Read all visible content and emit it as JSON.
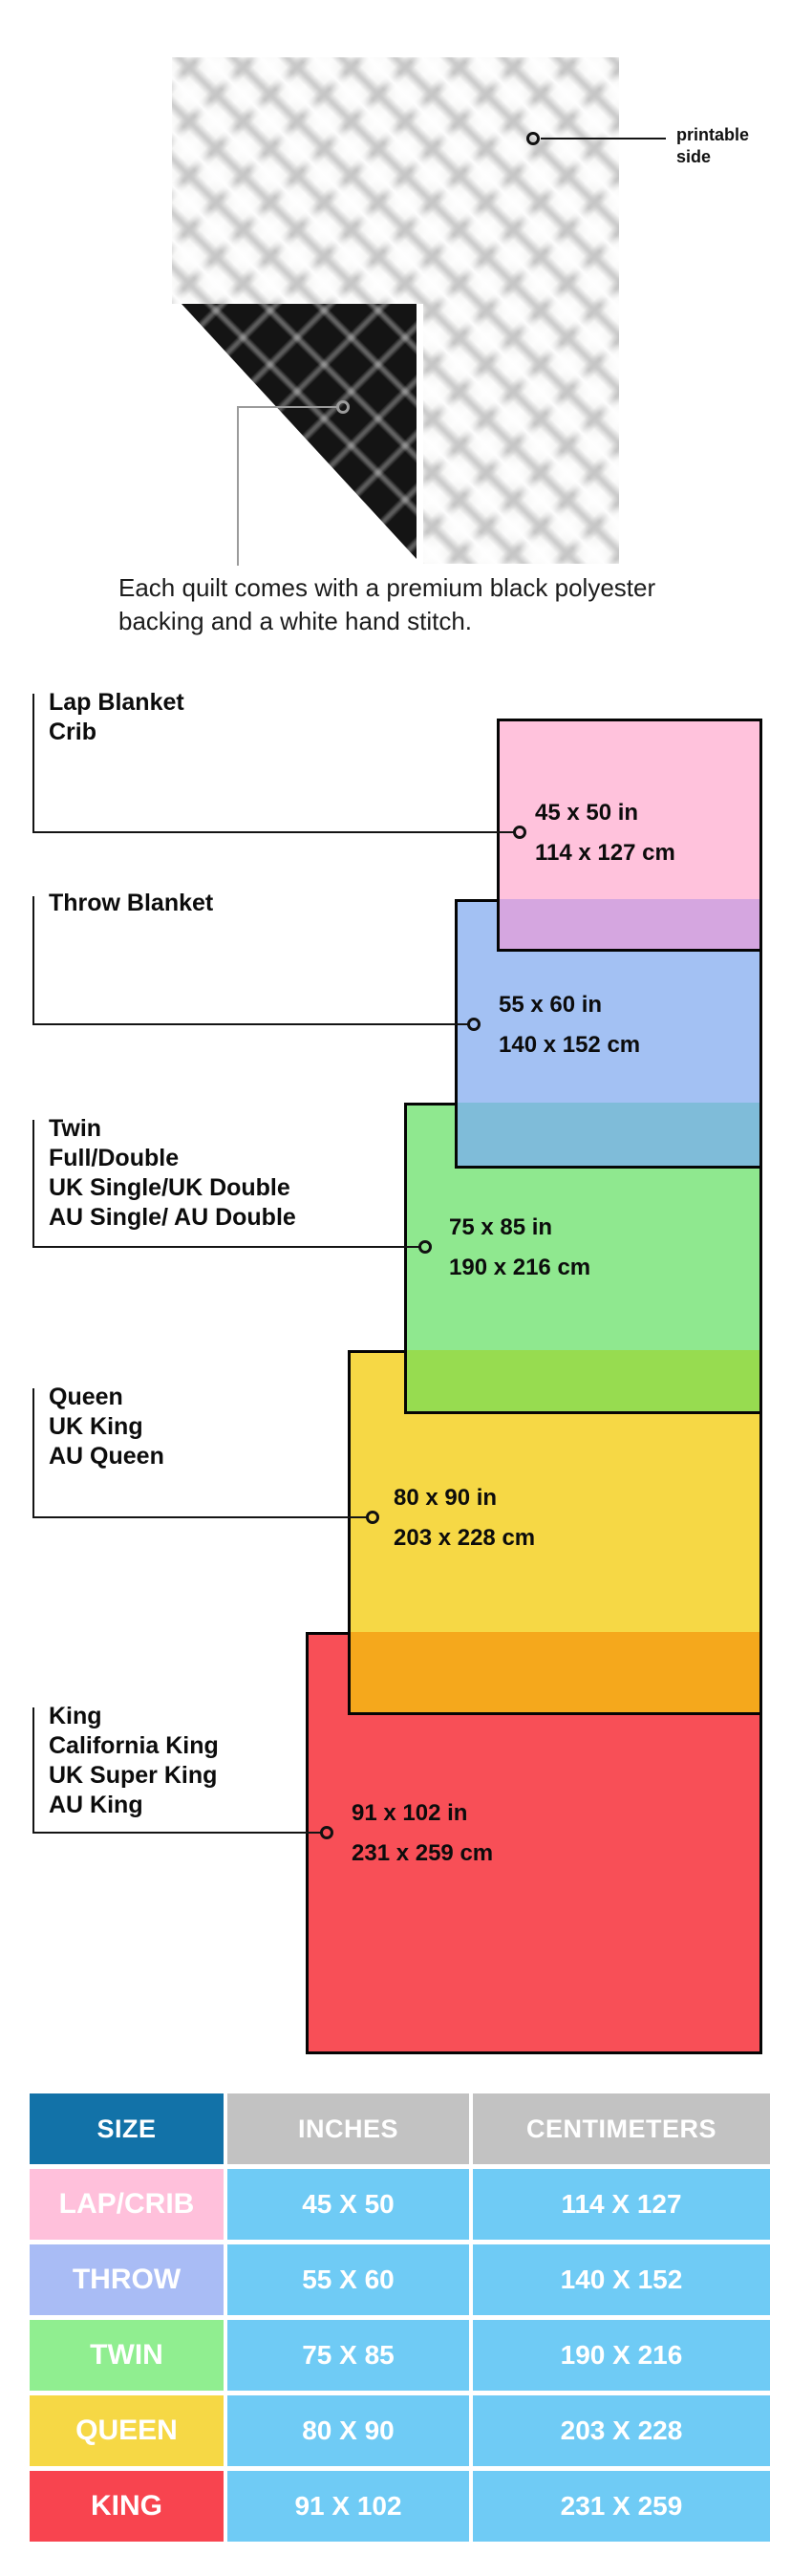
{
  "quilt": {
    "printable_label_line1": "printable",
    "printable_label_line2": "side",
    "caption_line1": "Each quilt comes with a premium black polyester",
    "caption_line2": "backing and a white hand stitch."
  },
  "diagram": {
    "items": [
      {
        "labels": [
          "Lap Blanket",
          "Crib"
        ],
        "inches": "45 x 50 in",
        "cm": "114 x 127 cm",
        "color": "#ffc2dc",
        "overlap_color": "#d5a6e0"
      },
      {
        "labels": [
          "Throw Blanket"
        ],
        "inches": "55 x 60 in",
        "cm": "140 x 152 cm",
        "color": "#a3c1f3",
        "overlap_color": "#7fbcd9"
      },
      {
        "labels": [
          "Twin",
          "Full/Double",
          "UK Single/UK Double",
          "AU Single/ AU Double"
        ],
        "inches": "75 x 85 in",
        "cm": "190 x 216 cm",
        "color": "#8fe88f",
        "overlap_color": "#97dc50"
      },
      {
        "labels": [
          "Queen",
          "UK King",
          "AU Queen"
        ],
        "inches": "80 x 90 in",
        "cm": "203 x 228 cm",
        "color": "#f6d845",
        "overlap_color": "#f5a81c"
      },
      {
        "labels": [
          "King",
          "California King",
          "UK Super King",
          "AU King"
        ],
        "inches": "91 x 102 in",
        "cm": "231 x 259 cm",
        "color": "#f84f57",
        "overlap_color": "#f5a81c"
      }
    ]
  },
  "table": {
    "headers": [
      "SIZE",
      "INCHES",
      "CENTIMETERS"
    ],
    "colors": {
      "header_size_bg": "#1272a8",
      "header_other_bg": "#c2c2c2",
      "value_bg": "#6fcbf5"
    },
    "rows": [
      {
        "size": "LAP/CRIB",
        "inches": "45 X 50",
        "cm": "114 X 127",
        "color": "#ffc0db"
      },
      {
        "size": "THROW",
        "inches": "55 X 60",
        "cm": "140 X 152",
        "color": "#a9bcf5"
      },
      {
        "size": "TWIN",
        "inches": "75 X 85",
        "cm": "190 X 216",
        "color": "#90ee90"
      },
      {
        "size": "QUEEN",
        "inches": "80 X 90",
        "cm": "203 X 228",
        "color": "#f6d845"
      },
      {
        "size": "KING",
        "inches": "91 X 102",
        "cm": "231 X 259",
        "color": "#f8444f"
      }
    ]
  }
}
